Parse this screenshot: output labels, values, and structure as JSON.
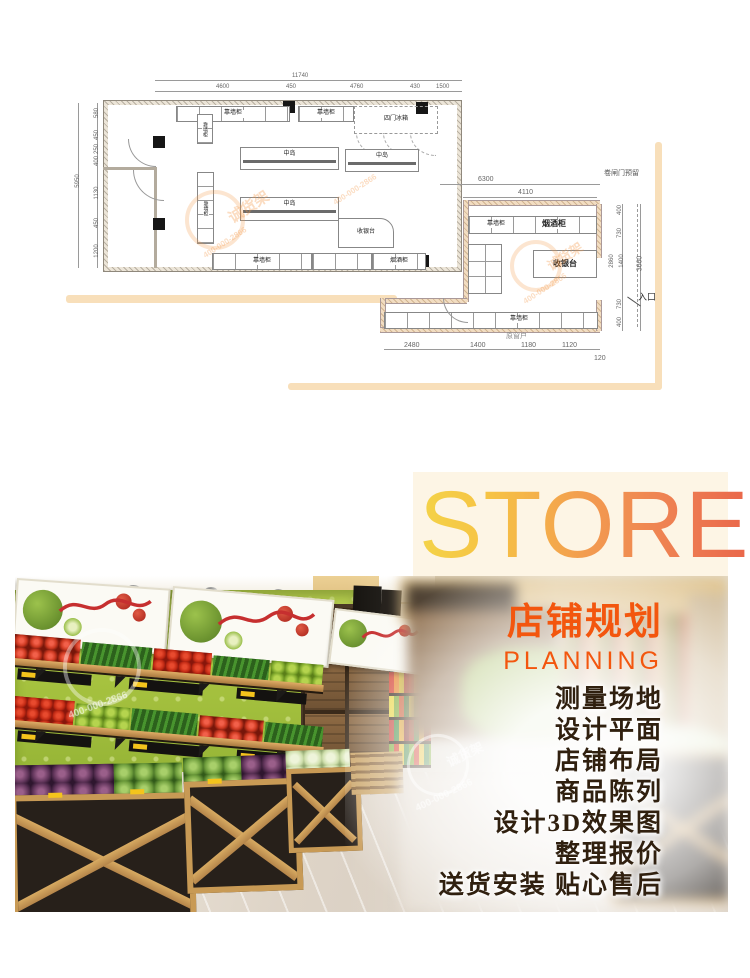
{
  "hero": {
    "title": "STORE"
  },
  "promo": {
    "title": "店铺规划",
    "subtitle": "PLANNING",
    "services": [
      "测量场地",
      "设计平面",
      "店铺布局",
      "商品陈列",
      "设计3D效果图",
      "整理报价",
      "送货安装 贴心售后"
    ]
  },
  "watermark": {
    "brand": "诚货架",
    "phone": "400-000-2866"
  },
  "plan1": {
    "dim_total_top": "11740",
    "dims_top": [
      "4600",
      "450",
      "4760",
      "430",
      "1500"
    ],
    "dim_total_left": "5950",
    "dims_left": [
      "580",
      "450",
      "250",
      "400",
      "1130",
      "450",
      "1200"
    ],
    "labels": {
      "wall_cabinet": "靠墙柜",
      "island": "中岛",
      "fridge": "四门冰箱",
      "cashier": "收银台",
      "tobacco": "烟酒柜"
    }
  },
  "plan2": {
    "labels": {
      "shutter": "卷闸门预留",
      "wall_cabinet": "靠墙柜",
      "tobacco": "烟酒柜",
      "cashier": "收银台",
      "window": "原窗户",
      "entrance": "入口"
    },
    "dims_top": [
      "6300",
      "4110"
    ],
    "dims_bottom": [
      "2480",
      "1400",
      "1180",
      "1120",
      "120"
    ],
    "dims_right": [
      "400",
      "730",
      "2860",
      "1400",
      "730",
      "400",
      "3660"
    ]
  }
}
